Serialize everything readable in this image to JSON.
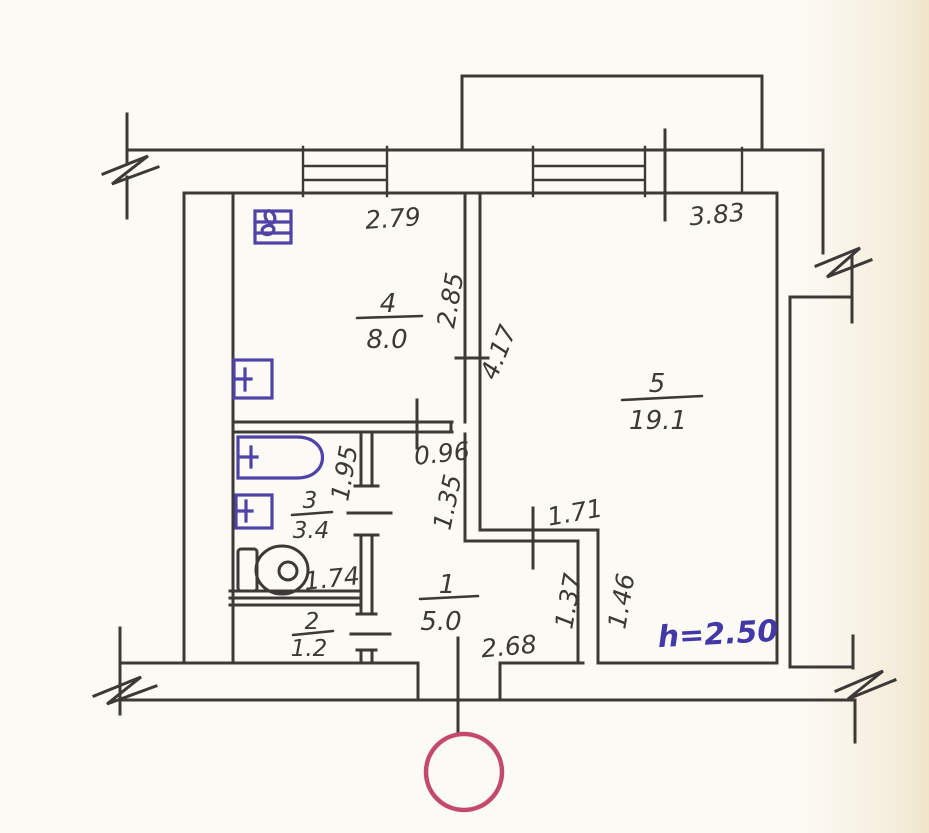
{
  "plan": {
    "rooms": [
      {
        "number": "4",
        "area": "8.0"
      },
      {
        "number": "5",
        "area": "19.1"
      },
      {
        "number": "3",
        "area": "3.4"
      },
      {
        "number": "2",
        "area": "1.2"
      },
      {
        "number": "1",
        "area": "5.0"
      }
    ],
    "dims": {
      "kitchen_width": "2.79",
      "living_width": "3.83",
      "kitchen_depth": "2.85",
      "living_depth": "4.17",
      "corridor_width": "0.96",
      "corridor_depth": "1.35",
      "bath_depth": "1.95",
      "bath_width": "1.74",
      "living_door_span": "1.71",
      "hall_wall_depth": "1.37",
      "living_notch_depth": "1.46",
      "hall_width": "2.68"
    },
    "ceiling_height_note": "h=2.50",
    "colors": {
      "line": "#3d3936",
      "plumbing_ink": "#4f43a8",
      "note_ink": "#4338a8",
      "stamp": "#c34a6e",
      "paper": "#fcfaf5"
    }
  }
}
